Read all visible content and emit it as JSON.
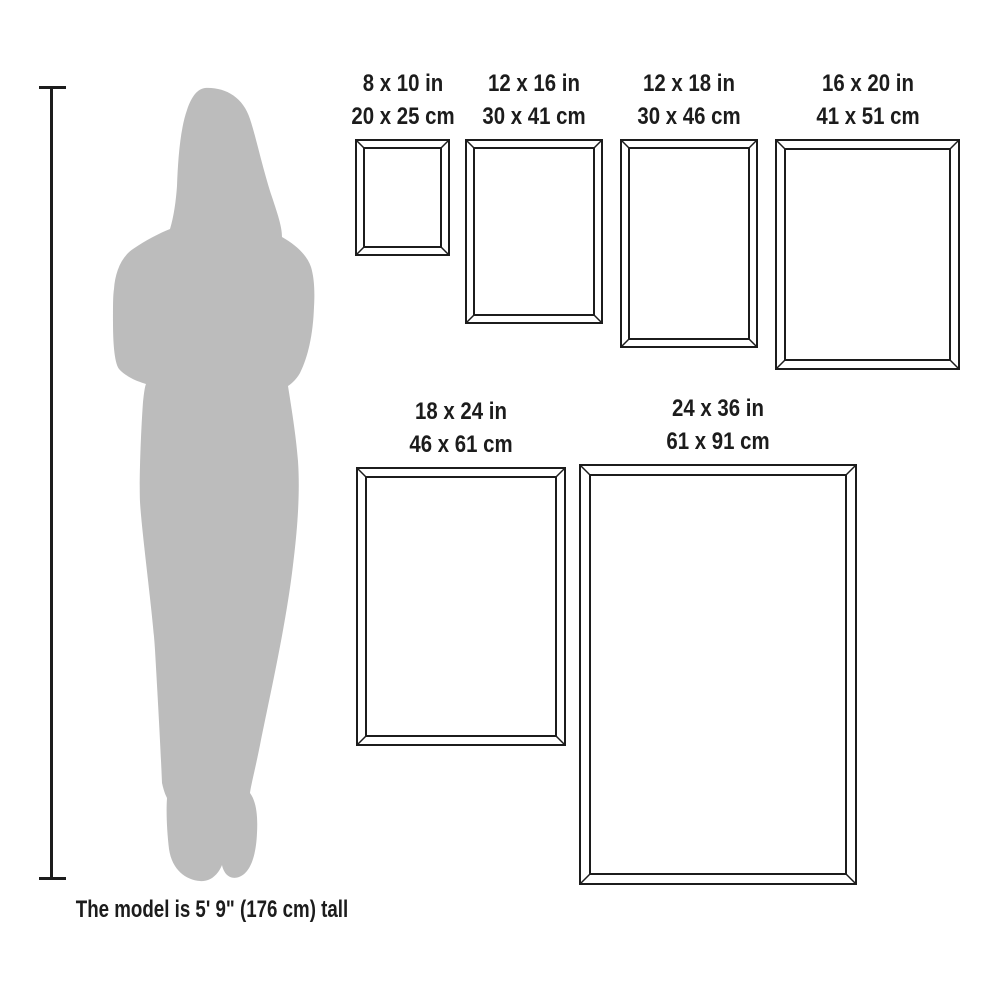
{
  "caption": "The model is 5' 9\" (176 cm) tall",
  "colors": {
    "line": "#1c1c1c",
    "text": "#1c1c1c",
    "silhouette": "#bcbcbc",
    "background": "#ffffff"
  },
  "frames": [
    {
      "size_in": "8 x 10 in",
      "size_cm": "20 x 25 cm",
      "box": {
        "x": 355,
        "y": 139,
        "w": 95,
        "h": 117,
        "bevel": 8
      }
    },
    {
      "size_in": "12 x 16 in",
      "size_cm": "30 x 41 cm",
      "box": {
        "x": 465,
        "y": 139,
        "w": 138,
        "h": 185,
        "bevel": 8
      }
    },
    {
      "size_in": "12 x 18 in",
      "size_cm": "30 x 46 cm",
      "box": {
        "x": 620,
        "y": 139,
        "w": 138,
        "h": 209,
        "bevel": 8
      }
    },
    {
      "size_in": "16 x 20 in",
      "size_cm": "41 x 51 cm",
      "box": {
        "x": 775,
        "y": 139,
        "w": 185,
        "h": 231,
        "bevel": 9
      }
    },
    {
      "size_in": "18 x 24 in",
      "size_cm": "46 x 61 cm",
      "box": {
        "x": 356,
        "y": 467,
        "w": 210,
        "h": 279,
        "bevel": 9
      }
    },
    {
      "size_in": "24 x 36 in",
      "size_cm": "61 x 91 cm",
      "box": {
        "x": 579,
        "y": 464,
        "w": 278,
        "h": 421,
        "bevel": 10
      }
    }
  ]
}
